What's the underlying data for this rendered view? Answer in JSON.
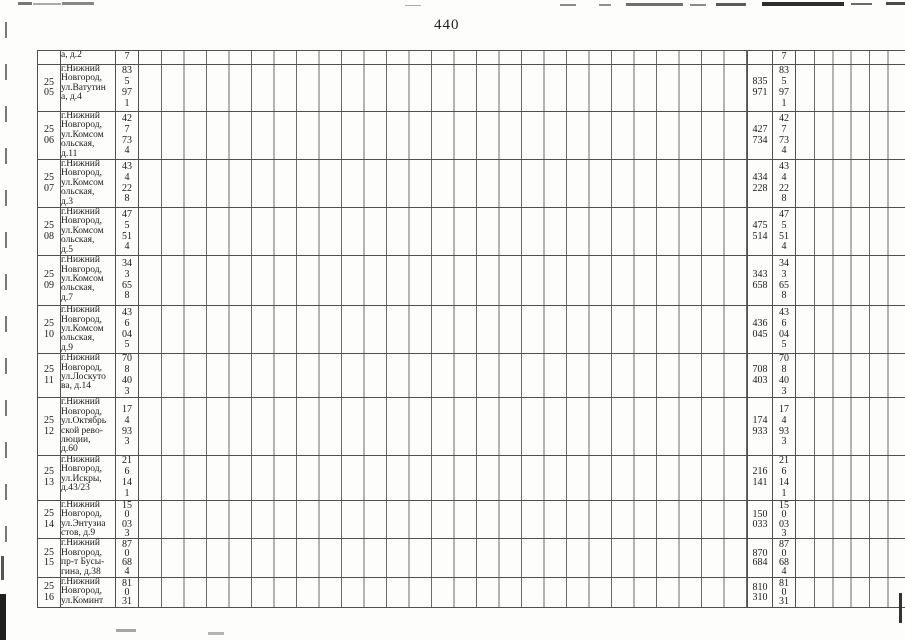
{
  "page": {
    "number": "440"
  },
  "colors": {
    "grid_line": "#4f4f4f",
    "text": "#1a1a1a",
    "paper": "#fdfdfc"
  },
  "table": {
    "rows": [
      {
        "num": "",
        "address": "а, д.2",
        "value_vertical": "7",
        "value_pair": "",
        "value_vertical_dup": "7"
      },
      {
        "num": "25\n05",
        "address": "г.Нижний\nНовгород,\nул.Ватутин\nа, д.4",
        "value_vertical": "83\n5\n97\n1",
        "value_pair": "835\n971",
        "value_vertical_dup": "83\n5\n97\n1"
      },
      {
        "num": "25\n06",
        "address": "г.Нижний\nНовгород,\nул.Комсом\nольская,\nд.11",
        "value_vertical": "42\n7\n73\n4",
        "value_pair": "427\n734",
        "value_vertical_dup": "42\n7\n73\n4"
      },
      {
        "num": "25\n07",
        "address": "г.Нижний\nНовгород,\nул.Комсом\nольская,\nд.3",
        "value_vertical": "43\n4\n22\n8",
        "value_pair": "434\n228",
        "value_vertical_dup": "43\n4\n22\n8"
      },
      {
        "num": "25\n08",
        "address": "г.Нижний\nНовгород,\nул.Комсом\nольская,\nд.5",
        "value_vertical": "47\n5\n51\n4",
        "value_pair": "475\n514",
        "value_vertical_dup": "47\n5\n51\n4"
      },
      {
        "num": "25\n09",
        "address": "г.Нижний\nНовгород,\nул.Комсом\nольская,\nд.7",
        "value_vertical": "34\n3\n65\n8",
        "value_pair": "343\n658",
        "value_vertical_dup": "34\n3\n65\n8"
      },
      {
        "num": "25\n10",
        "address": "г.Нижний\nНовгород,\nул.Комсом\nольская,\nд.9",
        "value_vertical": "43\n6\n04\n5",
        "value_pair": "436\n045",
        "value_vertical_dup": "43\n6\n04\n5"
      },
      {
        "num": "25\n11",
        "address": "г.Нижний\nНовгород,\nул.Лоскуто\nва, д.14",
        "value_vertical": "70\n8\n40\n3",
        "value_pair": "708\n403",
        "value_vertical_dup": "70\n8\n40\n3"
      },
      {
        "num": "25\n12",
        "address": "г.Нижний\nНовгород,\nул.Октябрь\nской рево-\nлюции,\nд.60",
        "value_vertical": "17\n4\n93\n3",
        "value_pair": "174\n933",
        "value_vertical_dup": "17\n4\n93\n3"
      },
      {
        "num": "25\n13",
        "address": "г.Нижний\nНовгород,\nул.Искры,\nд.43/23",
        "value_vertical": "21\n6\n14\n1",
        "value_pair": "216\n141",
        "value_vertical_dup": "21\n6\n14\n1"
      },
      {
        "num": "25\n14",
        "address": "г.Нижний\nНовгород,\nул.Энтузиа\nстов, д.9",
        "value_vertical": "15\n0\n03\n3",
        "value_pair": "150\n033",
        "value_vertical_dup": "15\n0\n03\n3"
      },
      {
        "num": "25\n15",
        "address": "г.Нижний\nНовгород,\nпр-т Бусы-\nгина, д.38",
        "value_vertical": "87\n0\n68\n4",
        "value_pair": "870\n684",
        "value_vertical_dup": "87\n0\n68\n4"
      },
      {
        "num": "25\n16",
        "address": "г.Нижний\nНовгород,\nул.Коминт",
        "value_vertical": "81\n0\n31",
        "value_pair": "810\n310",
        "value_vertical_dup": "81\n0\n31"
      }
    ]
  }
}
